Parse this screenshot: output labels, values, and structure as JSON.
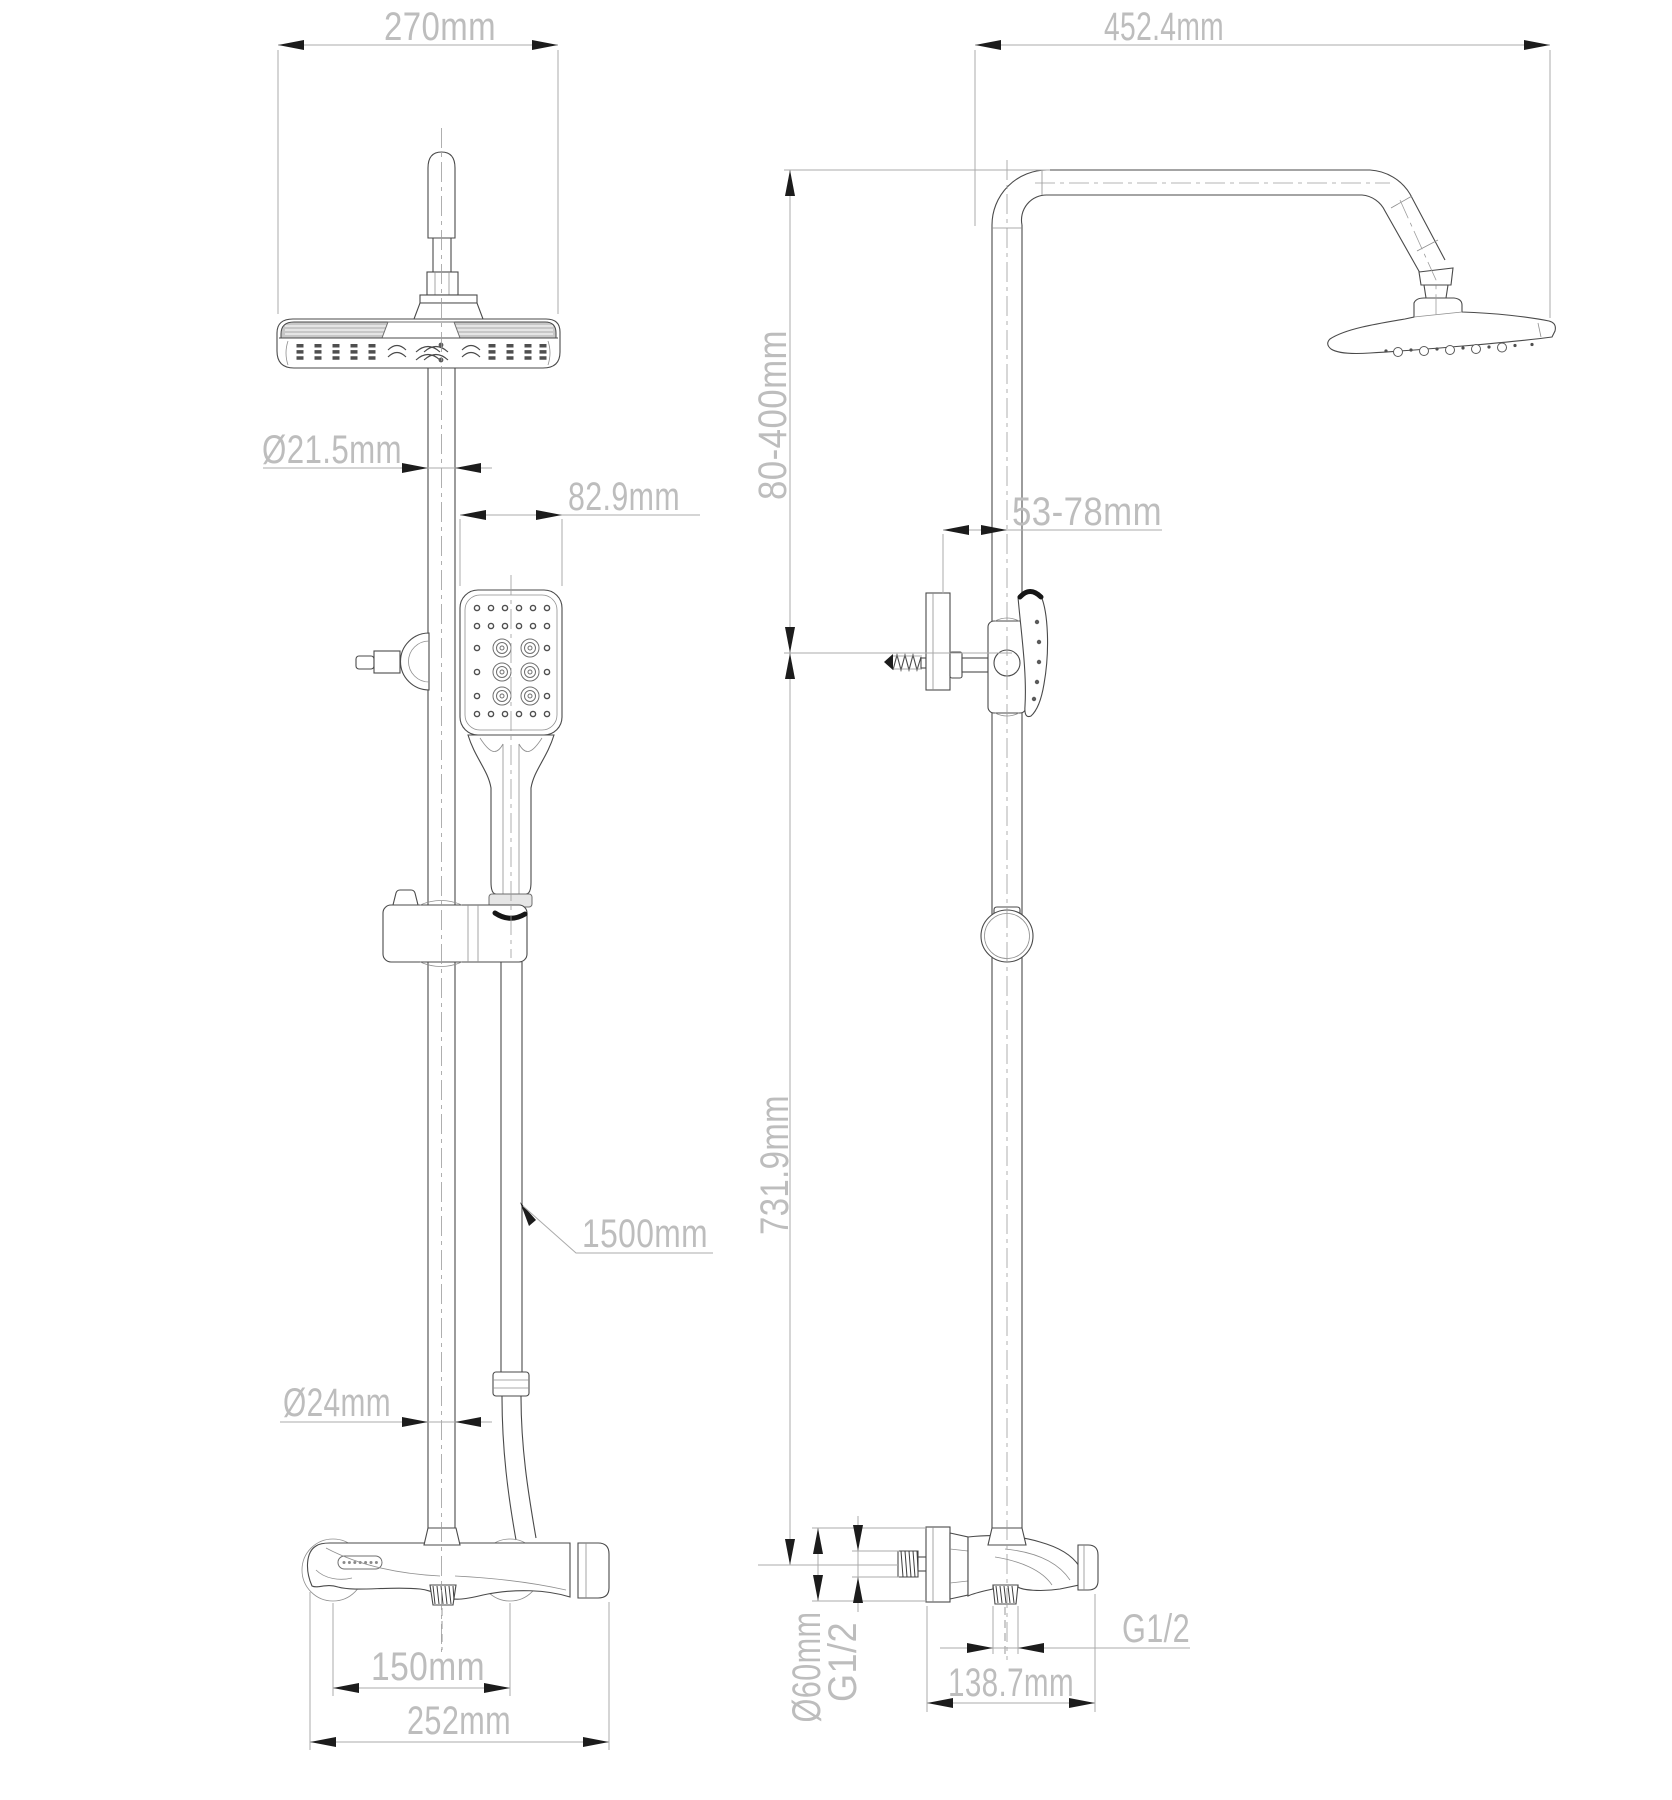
{
  "page": {
    "background": "#ffffff",
    "line_color": "#4a4a4a",
    "dim_line_color": "#ababab",
    "dim_text_color": "#bdbdbd",
    "arrow_color": "#1c1c1c"
  },
  "front_view": {
    "head_width": "270mm",
    "rail_upper_diameter": "Ø21.5mm",
    "handshower_width": "82.9mm",
    "hose_length": "1500mm",
    "rail_lower_diameter": "Ø24mm",
    "inlet_spacing": "150mm",
    "mixer_width": "252mm"
  },
  "side_view": {
    "arm_reach": "452.4mm",
    "bracket_height_range": "80-400mm",
    "wall_clearance": "53-78mm",
    "rail_length": "731.9mm",
    "escutcheon_diameter": "Ø60mm",
    "inlet_thread": "G1/2",
    "outlet_thread": "G1/2",
    "body_depth": "138.7mm"
  }
}
